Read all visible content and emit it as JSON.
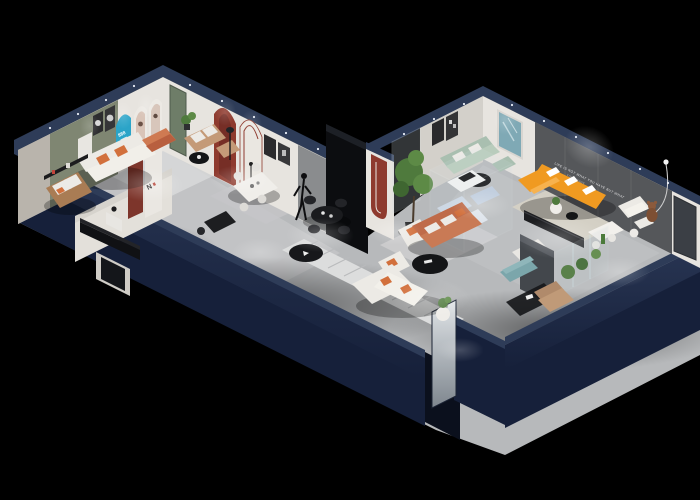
{
  "description": "3D isometric cutaway render of a furniture showroom floor plan on a black background",
  "texts": {
    "accent_wall_slogan_line1": "LIFE IS NOT WHAT YOU HAVE BUT WHAT",
    "accent_wall_slogan_line2": "YOU ENJOY",
    "arch_display_number": "888",
    "arch_monogram": "N"
  },
  "palette": {
    "background": "#000000",
    "wall_navy_top": "#2e3c58",
    "wall_navy_face": "#16203a",
    "wall_navy_deep": "#0b101d",
    "floor_gray": "#b7b9bb",
    "floor_light": "#cdced0",
    "rug_light": "#dadbdb",
    "wall_white": "#e7e4df",
    "wall_olive": "#7f8672",
    "accent_panel_gray": "#55575a",
    "arch_cyan": "#2ba4c8",
    "arch_red": "#8e3a2e",
    "door_green": "#6e7d68",
    "sofa_orange": "#f09a21",
    "sofa_terracotta": "#bf6b49",
    "sofa_sage": "#a9bfb0",
    "sofa_white": "#eceae5",
    "leather_tan": "#a97c54",
    "pillow_orange": "#d2703c",
    "bench_teal": "#7ba6ab",
    "plant_green": "#4f7a3d",
    "furniture_black": "#141517"
  }
}
